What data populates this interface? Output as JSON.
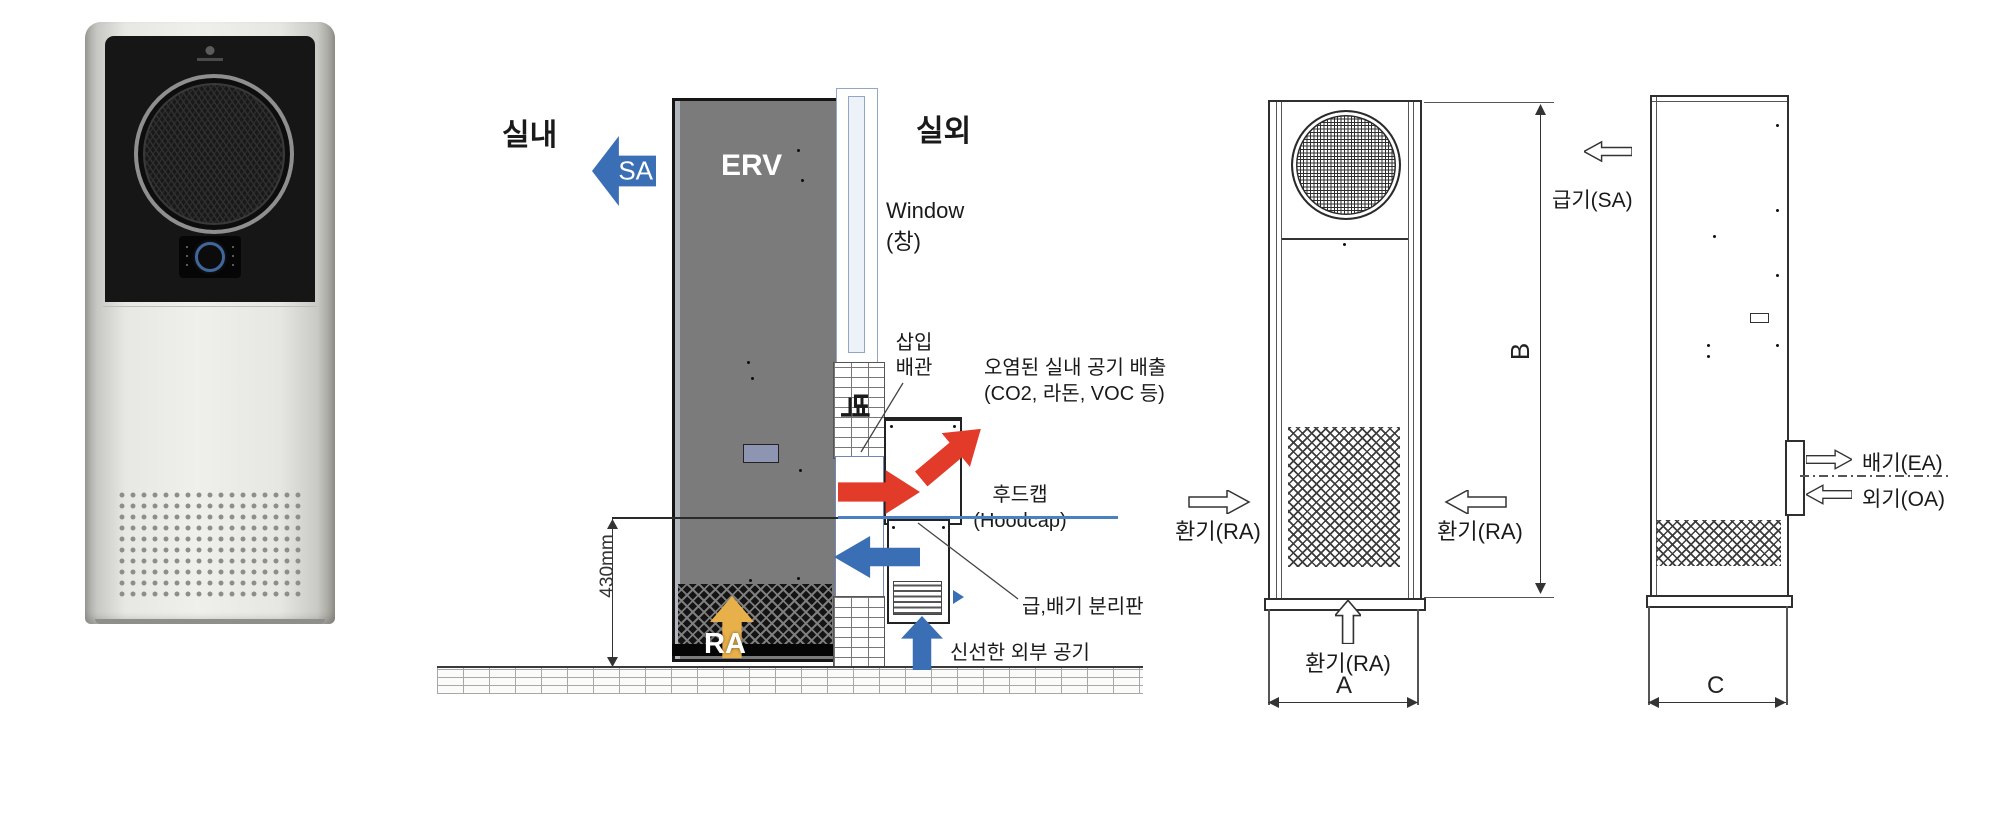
{
  "installation": {
    "indoor": "실내",
    "outdoor": "실외",
    "sa": "SA",
    "erv": "ERV",
    "ra": "RA",
    "window_line1": "Window",
    "window_line2": "(창)",
    "wall": "벽",
    "insert_pipe_line1": "삽입",
    "insert_pipe_line2": "배관",
    "exhaust_line1": "오염된 실내 공기 배출",
    "exhaust_line2": "(CO2, 라돈, VOC 등)",
    "hoodcap_line1": "후드캡",
    "hoodcap_line2": "(Hoodcap)",
    "separator": "급,배기 분리판",
    "fresh_air": "신선한 외부 공기",
    "height_dim": "430mm"
  },
  "front_view": {
    "dim_width": "A",
    "dim_height": "B",
    "ra_left": "환기(RA)",
    "ra_right": "환기(RA)",
    "ra_bottom": "환기(RA)"
  },
  "side_view": {
    "dim_depth": "C",
    "sa": "급기(SA)",
    "ea": "배기(EA)",
    "oa": "외기(OA)"
  },
  "colors": {
    "arrow_blue": "#3a6fb5",
    "arrow_red": "#e23b2a",
    "arrow_yellow": "#e8b04a",
    "erv_gray": "#7b7b7b",
    "hood_line_blue": "#4a7fc1",
    "drawing_line": "#333333",
    "window_frame": "#93a6c9"
  }
}
